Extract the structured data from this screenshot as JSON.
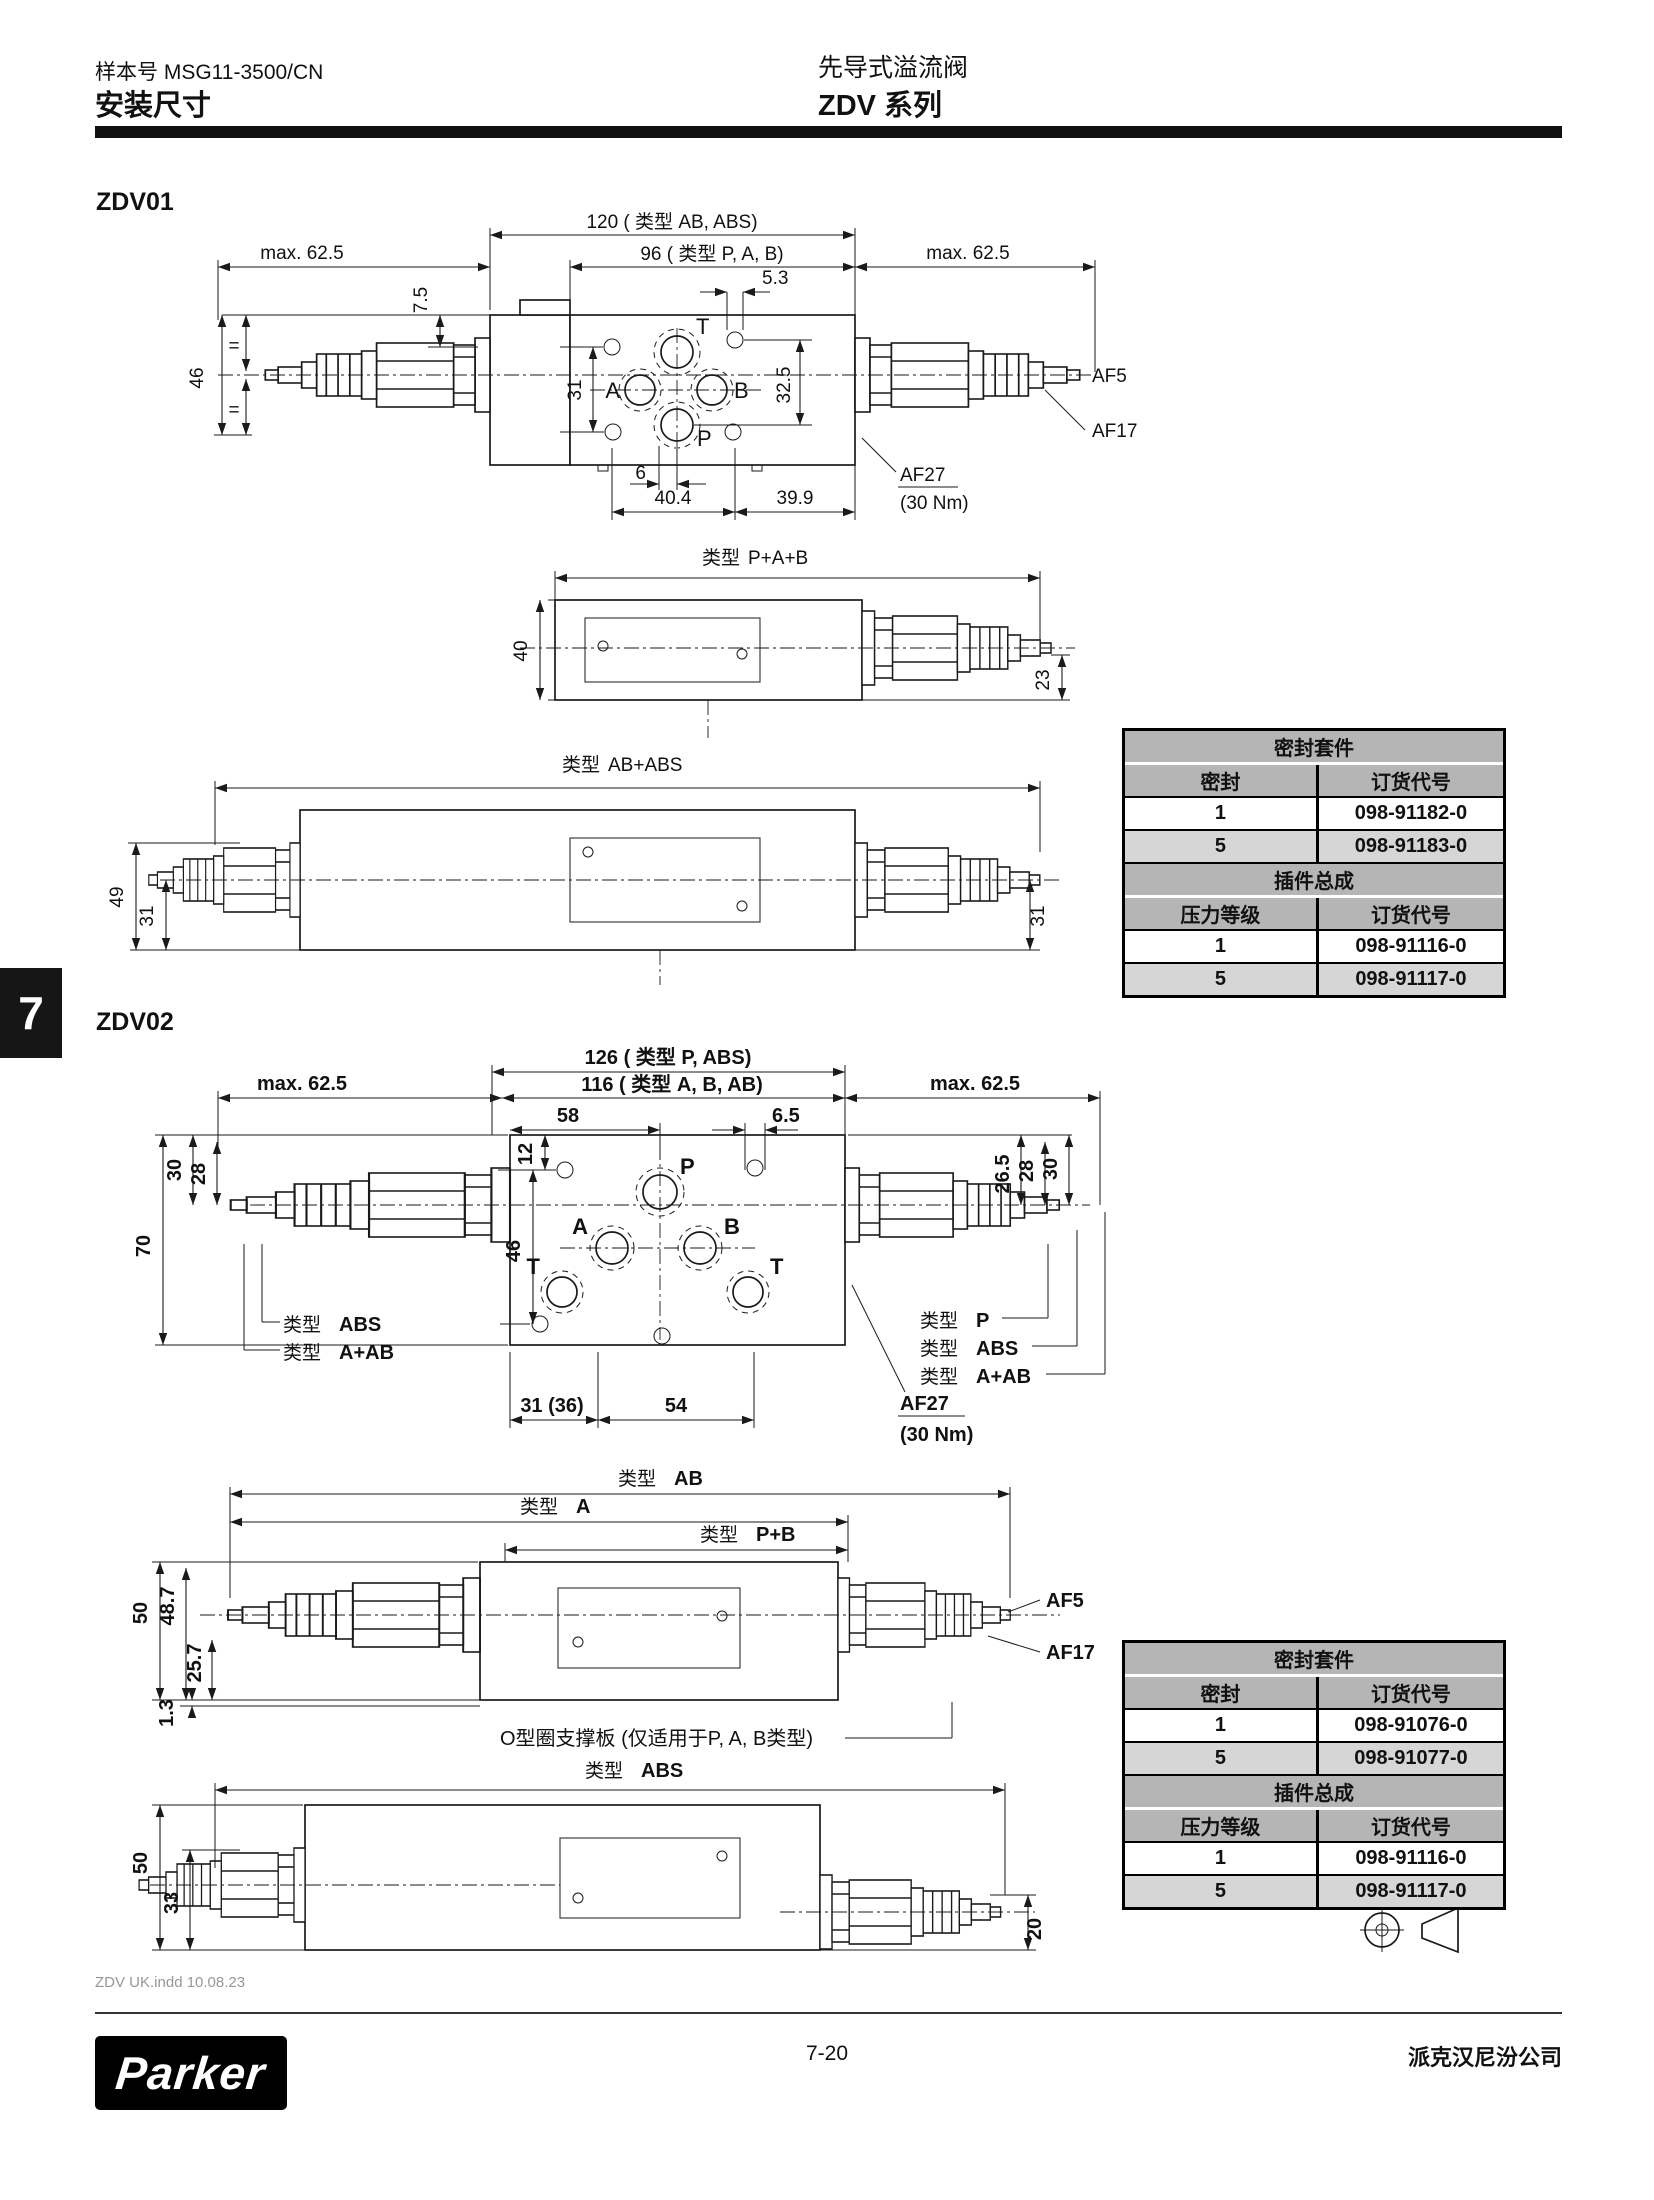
{
  "header": {
    "doc_no": "样本号 MSG11-3500/CN",
    "title": "安装尺寸",
    "product": "先导式溢流阀",
    "series": "ZDV 系列"
  },
  "tab_number": "7",
  "zdv01": {
    "heading": "ZDV01",
    "top": {
      "dim_type_ab_abs": "120 ( 类型 AB, ABS)",
      "dim_type_pab": "96 ( 类型 P, A, B)",
      "dim_max_left": "max. 62.5",
      "dim_max_right": "max. 62.5",
      "dim_5_3": "5.3",
      "dim_7_5": "7.5",
      "dim_46": "46",
      "eq": "=",
      "dim_31": "31",
      "dim_32_5": "32.5",
      "dim_6": "6",
      "dim_40_4": "40.4",
      "dim_39_9": "39.9",
      "port_t": "T",
      "port_a": "A",
      "port_b": "B",
      "port_p": "P",
      "af5": "AF5",
      "af17": "AF17",
      "af27": "AF27",
      "af27_torque": "(30 Nm)"
    },
    "view_pab": {
      "type_prefix": "类型",
      "type_value": "P+A+B",
      "dim_40": "40",
      "dim_23": "23"
    },
    "view_ababs": {
      "type_prefix": "类型",
      "type_value": "AB+ABS",
      "dim_49": "49",
      "dim_31_left": "31",
      "dim_31_right": "31"
    }
  },
  "zdv02": {
    "heading": "ZDV02",
    "top": {
      "dim_type_p_abs": "126 ( 类型 P, ABS)",
      "dim_type_abab": "116 ( 类型 A, B, AB)",
      "dim_max_left": "max. 62.5",
      "dim_max_right": "max. 62.5",
      "dim_58": "58",
      "dim_6_5": "6.5",
      "dim_12": "12",
      "dim_46": "46",
      "dim_70": "70",
      "dim_30_left": "30",
      "dim_28_left": "28",
      "dim_26_5": "26.5",
      "dim_28_right": "28",
      "dim_30_right": "30",
      "dim_31_36": "31 (36)",
      "dim_54": "54",
      "port_p": "P",
      "port_a": "A",
      "port_b": "B",
      "port_t_left": "T",
      "port_t_right": "T",
      "label_abs": {
        "prefix": "类型",
        "value": "ABS"
      },
      "label_aab": {
        "prefix": "类型",
        "value": "A+AB"
      },
      "label_p_right": {
        "prefix": "类型",
        "value": "P"
      },
      "label_abs_right": {
        "prefix": "类型",
        "value": "ABS"
      },
      "label_aab_right": {
        "prefix": "类型",
        "value": "A+AB"
      },
      "af27": "AF27",
      "af27_torque": "(30 Nm)"
    },
    "view_ab": {
      "label_ab": {
        "prefix": "类型",
        "value": "AB"
      },
      "label_a": {
        "prefix": "类型",
        "value": "A"
      },
      "label_pb": {
        "prefix": "类型",
        "value": "P+B"
      },
      "dim_50": "50",
      "dim_48_7": "48.7",
      "dim_25_7": "25.7",
      "dim_1_3": "1.3",
      "af5": "AF5",
      "af17": "AF17",
      "oring_note": "O型圈支撑板 (仅适用于P, A, B类型)"
    },
    "view_abs": {
      "label": {
        "prefix": "类型",
        "value": "ABS"
      },
      "dim_50": "50",
      "dim_33": "33",
      "dim_20": "20"
    },
    "pictogram": "seal-cartridge-icon"
  },
  "tables": [
    {
      "group1_title": "密封套件",
      "col_seal": "密封",
      "col_code": "订货代号",
      "seal_rows": [
        {
          "qty": "1",
          "code": "098-91182-0"
        },
        {
          "qty": "5",
          "code": "098-91183-0"
        }
      ],
      "group2_title": "插件总成",
      "col_grade": "压力等级",
      "col_code2": "订货代号",
      "cartridge_rows": [
        {
          "grade": "1",
          "code": "098-91116-0"
        },
        {
          "grade": "5",
          "code": "098-91117-0"
        }
      ]
    },
    {
      "group1_title": "密封套件",
      "col_seal": "密封",
      "col_code": "订货代号",
      "seal_rows": [
        {
          "qty": "1",
          "code": "098-91076-0"
        },
        {
          "qty": "5",
          "code": "098-91077-0"
        }
      ],
      "group2_title": "插件总成",
      "col_grade": "压力等级",
      "col_code2": "订货代号",
      "cartridge_rows": [
        {
          "grade": "1",
          "code": "098-91116-0"
        },
        {
          "grade": "5",
          "code": "098-91117-0"
        }
      ]
    }
  ],
  "footer": {
    "file_note": "ZDV UK.indd 10.08.23",
    "page": "7-20",
    "company": "派克汉尼汾公司",
    "logo": "Parker"
  }
}
